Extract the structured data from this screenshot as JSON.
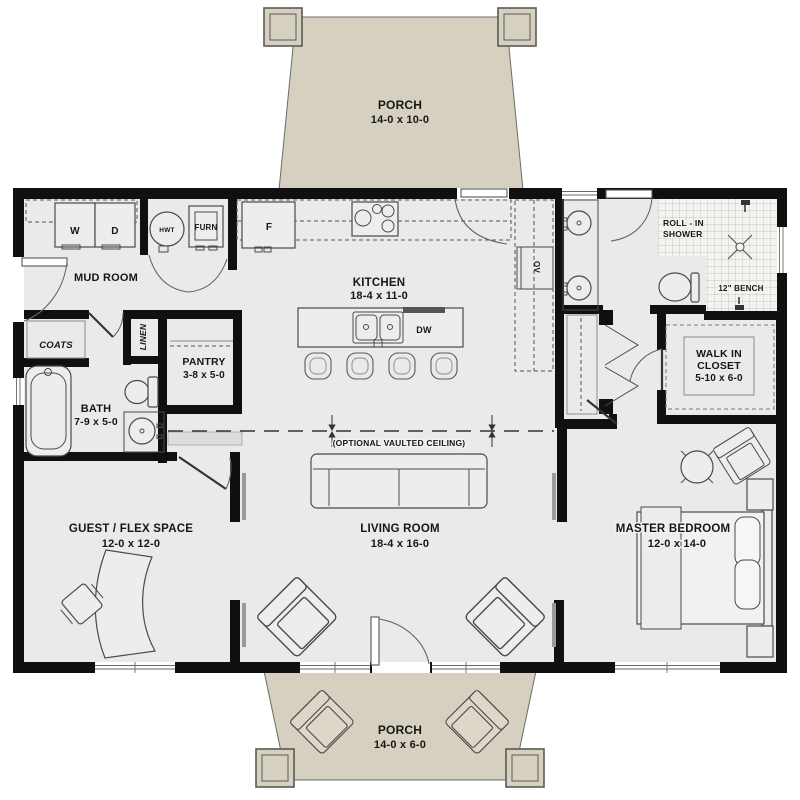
{
  "rooms": {
    "porch_top": {
      "name": "PORCH",
      "dims": "14-0 x 10-0"
    },
    "mud_room": {
      "name": "MUD ROOM"
    },
    "kitchen": {
      "name": "KITCHEN",
      "dims": "18-4 x 11-0"
    },
    "pantry": {
      "name": "PANTRY",
      "dims": "3-8 x 5-0"
    },
    "bath": {
      "name": "BATH",
      "dims": "7-9 x 5-0"
    },
    "guest_flex": {
      "name": "GUEST / FLEX SPACE",
      "dims": "12-0 x 12-0"
    },
    "living_room": {
      "name": "LIVING ROOM",
      "dims": "18-4 x 16-0"
    },
    "master_bedroom": {
      "name": "MASTER BEDROOM",
      "dims": "12-0 x 14-0"
    },
    "walk_in_closet": {
      "line1": "WALK IN",
      "line2": "CLOSET",
      "dims": "5-10 x 6-0"
    },
    "porch_bottom": {
      "name": "PORCH",
      "dims": "14-0 x 6-0"
    }
  },
  "fixtures": {
    "washer": "W",
    "dryer": "D",
    "water_heater": "HWT",
    "furnace": "FURN",
    "fridge": "F",
    "dishwasher": "DW",
    "wall_oven": "OV",
    "coats": "COATS",
    "linen": "LINEN",
    "shower_line1": "ROLL - IN",
    "shower_line2": "SHOWER",
    "bench": "12\" BENCH"
  },
  "notes": {
    "vaulted_ceiling": "(OPTIONAL VAULTED CEILING)"
  },
  "colors": {
    "wall": "#101010",
    "floor": "#eaeaea",
    "porch": "#d6d0c1",
    "outline": "#4a4a4a"
  }
}
